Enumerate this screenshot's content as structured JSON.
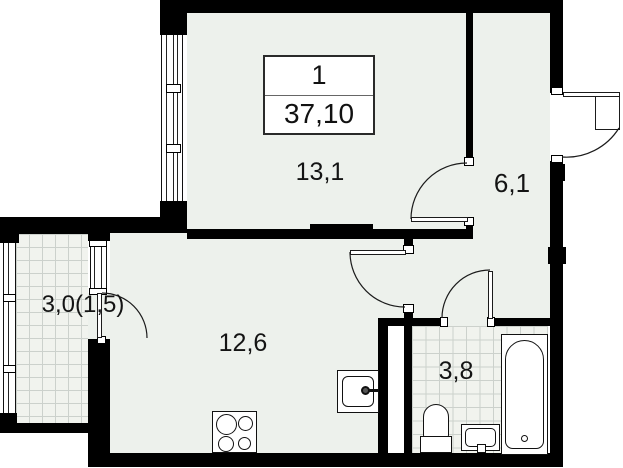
{
  "plan": {
    "title_box": {
      "flat_number": "1",
      "total_area": "37,10"
    },
    "rooms": [
      {
        "id": "living-room",
        "area_label": "13,1"
      },
      {
        "id": "hallway",
        "area_label": "6,1"
      },
      {
        "id": "kitchen-living-area",
        "area_label": "12,6"
      },
      {
        "id": "bathroom",
        "area_label": "3,8"
      },
      {
        "id": "balcony",
        "area_label": "3,0(1,5)"
      }
    ],
    "fixtures": [
      "bathtub",
      "toilet",
      "washbasin",
      "kitchen-sink",
      "stove-4-burner"
    ],
    "colors": {
      "wall": "#000000",
      "floor": "#edf1ec",
      "tile_grid": "#ccd1cc",
      "outside": "#ffffff",
      "line": "#1b1b1b"
    }
  }
}
